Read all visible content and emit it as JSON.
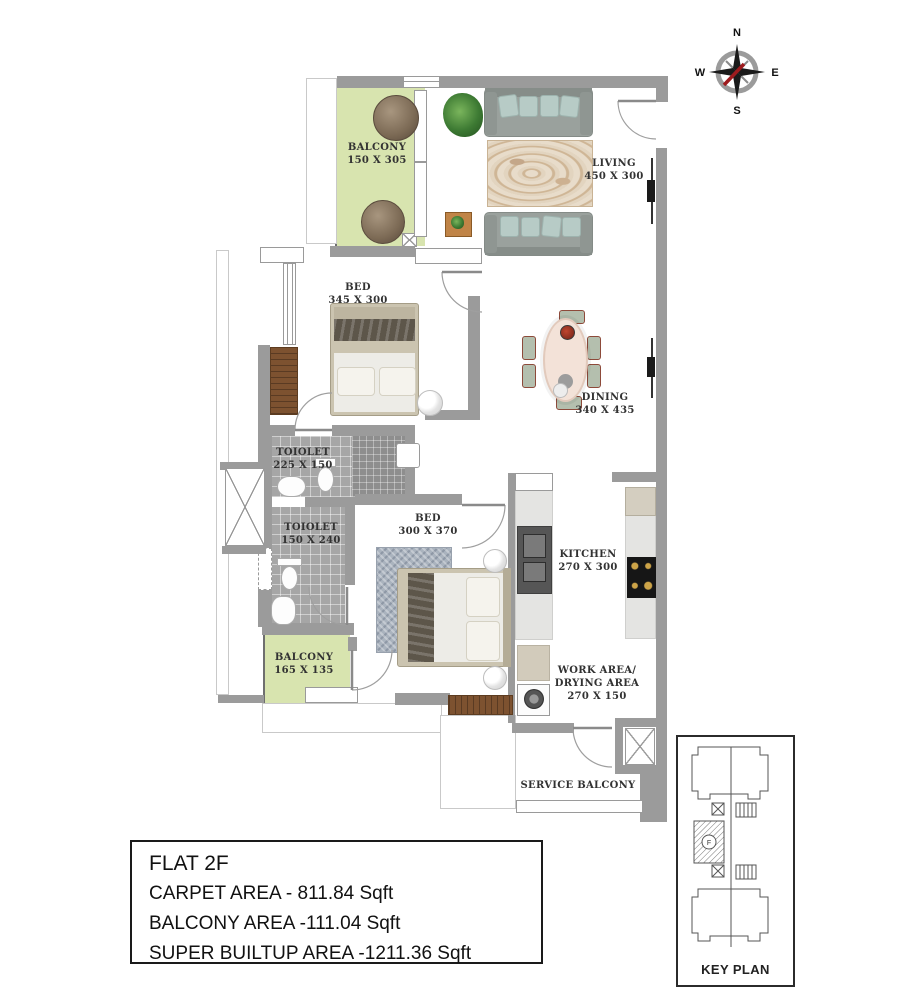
{
  "compass": {
    "n": "N",
    "e": "E",
    "s": "S",
    "w": "W"
  },
  "rooms": {
    "balcony_top": {
      "label": "BALCONY",
      "dims": "150 X 305"
    },
    "living": {
      "label": "LIVING",
      "dims": "450 X 300"
    },
    "bed1": {
      "label": "BED",
      "dims": "345 X 300"
    },
    "dining": {
      "label": "DINING",
      "dims": "340 X 435"
    },
    "toilet1": {
      "label": "TOIOLET",
      "dims": "225 X 150"
    },
    "toilet2": {
      "label": "TOIOLET",
      "dims": "150 X 240"
    },
    "bed2": {
      "label": "BED",
      "dims": "300 X 370"
    },
    "kitchen": {
      "label": "KITCHEN",
      "dims": "270 X 300"
    },
    "balcony_bottom": {
      "label": "BALCONY",
      "dims": "165 X 135"
    },
    "work_area": {
      "line1": "WORK AREA/",
      "line2": "DRYING AREA",
      "dims": "270 X 150"
    },
    "service_balcony": {
      "label": "SERVICE BALCONY"
    }
  },
  "info_box": {
    "flat": "FLAT 2F",
    "carpet": "CARPET AREA - 811.84 Sqft",
    "balcony": "BALCONY AREA -111.04 Sqft",
    "super_builtup": "SUPER BUILTUP AREA -1211.36 Sqft"
  },
  "key_plan": {
    "label": "KEY PLAN",
    "flat_marker": "F"
  },
  "colors": {
    "wall": "#9b9b9b",
    "balcony_floor": "#d8e4af",
    "wood": "#7d5230",
    "accent_red": "#9e1b1e"
  }
}
